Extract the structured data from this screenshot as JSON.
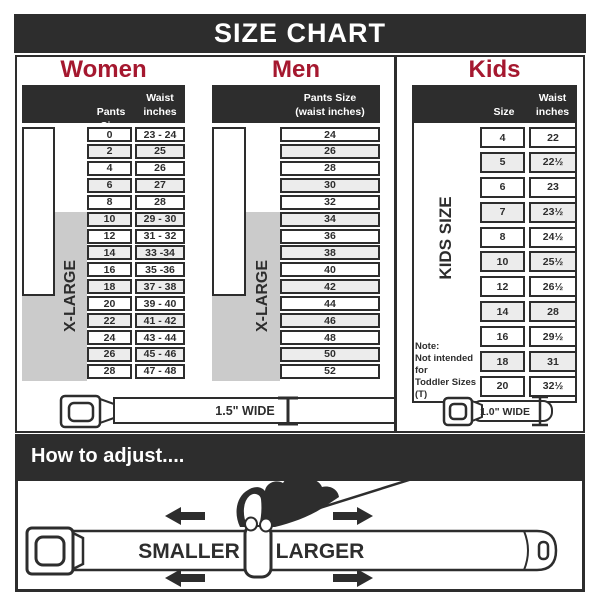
{
  "title": "SIZE CHART",
  "sections": {
    "women": {
      "title": "Women",
      "header": {
        "col1": "Pants Size",
        "col2_line1": "Waist",
        "col2_line2": "inches"
      },
      "labels": {
        "regular": "REGULAR SIZE",
        "xlarge": "X-LARGE"
      },
      "rows": [
        [
          "0",
          "23 - 24"
        ],
        [
          "2",
          "25"
        ],
        [
          "4",
          "26"
        ],
        [
          "6",
          "27"
        ],
        [
          "8",
          "28"
        ],
        [
          "10",
          "29 - 30"
        ],
        [
          "12",
          "31 - 32"
        ],
        [
          "14",
          "33 -34"
        ],
        [
          "16",
          "35 -36"
        ],
        [
          "18",
          "37 - 38"
        ],
        [
          "20",
          "39 - 40"
        ],
        [
          "22",
          "41 - 42"
        ],
        [
          "24",
          "43 - 44"
        ],
        [
          "26",
          "45 - 46"
        ],
        [
          "28",
          "47 - 48"
        ]
      ]
    },
    "men": {
      "title": "Men",
      "header": {
        "line1": "Pants Size",
        "line2": "(waist inches)"
      },
      "labels": {
        "regular": "REGULAR SIZE",
        "xlarge": "X-LARGE"
      },
      "rows": [
        "24",
        "26",
        "28",
        "30",
        "32",
        "34",
        "36",
        "38",
        "40",
        "42",
        "44",
        "46",
        "48",
        "50",
        "52"
      ]
    },
    "kids": {
      "title": "Kids",
      "header": {
        "col1": "Size",
        "col2_line1": "Waist",
        "col2_line2": "inches"
      },
      "label": "KIDS SIZE",
      "note": {
        "line1": "Note:",
        "line2": "Not intended for",
        "line3": "Toddler Sizes (T)"
      },
      "rows": [
        [
          "4",
          "22"
        ],
        [
          "5",
          "22½"
        ],
        [
          "6",
          "23"
        ],
        [
          "7",
          "23½"
        ],
        [
          "8",
          "24½"
        ],
        [
          "10",
          "25½"
        ],
        [
          "12",
          "26½"
        ],
        [
          "14",
          "28"
        ],
        [
          "16",
          "29½"
        ],
        [
          "18",
          "31"
        ],
        [
          "20",
          "32½"
        ]
      ]
    }
  },
  "belts": {
    "adult_width": "1.5\" WIDE",
    "kids_width": "1.0\" WIDE"
  },
  "adjust": {
    "title": "How to adjust....",
    "smaller": "SMALLER",
    "larger": "LARGER"
  },
  "colors": {
    "dark": "#2d2d2d",
    "red": "#a5182f",
    "gray_box": "#cbcbcb",
    "row_alt": "#ececec"
  }
}
